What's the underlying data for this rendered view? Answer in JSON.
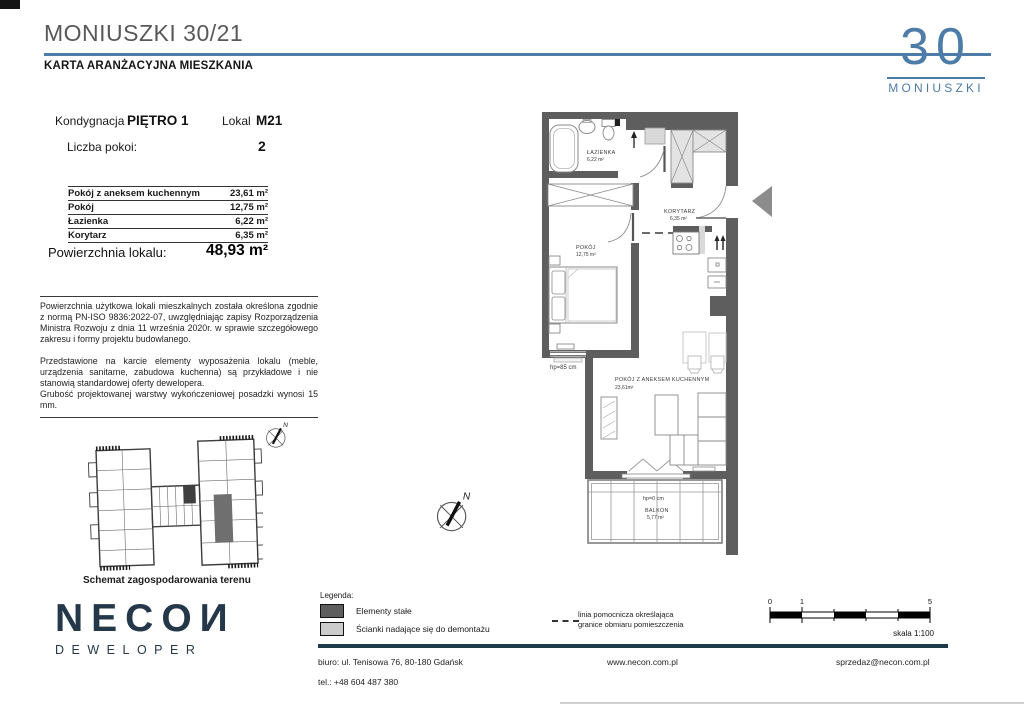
{
  "header": {
    "title": "MONIUSZKI 30/21",
    "subtitle": "KARTA ARANŻACYJNA MIESZKANIA",
    "logo_number": "30",
    "logo_name": "MONIUSZKI"
  },
  "info": {
    "kondygnacja_label": "Kondygnacja",
    "kondygnacja_value": "PIĘTRO 1",
    "lokal_label": "Lokal",
    "lokal_value": "M21",
    "liczba_pokoi_label": "Liczba pokoi:",
    "liczba_pokoi_value": "2",
    "rooms": [
      {
        "name": "Pokój z aneksem kuchennym",
        "area": "23,61 m²"
      },
      {
        "name": "Pokój",
        "area": "12,75 m²"
      },
      {
        "name": "Łazienka",
        "area": "6,22 m²"
      },
      {
        "name": "Korytarz",
        "area": "6,35 m²"
      }
    ],
    "total_label": "Powierzchnia lokalu:",
    "total_value": "48,93 m²"
  },
  "disclaimer": {
    "p1": "Powierzchnia użytkowa lokali mieszkalnych została określona zgodnie z normą PN-ISO 9836:2022-07, uwzględniając zapisy Rozporządzenia Ministra Rozwoju z dnia 11 września 2020r. w sprawie szczegółowego zakresu i formy projektu budowlanego.",
    "p2": "Przedstawione na karcie elementy wyposażenia lokalu (meble, urządzenia sanitarne, zabudowa kuchenna) są przykładowe i nie stanowią standardowej oferty dewelopera.",
    "p3": "Grubość projektowanej warstwy wykończeniowej posadzki wynosi 15 mm."
  },
  "site_plan": {
    "caption": "Schemat zagospodarowania terenu"
  },
  "developer": {
    "logo_text": "NECOИ",
    "logo_sub": "DEWELOPER"
  },
  "plan": {
    "rooms": {
      "lazienka": {
        "name": "ŁAZIENKA",
        "area": "6,22 m²"
      },
      "korytarz": {
        "name": "KORYTARZ",
        "area": "6,35 m²"
      },
      "pokoj": {
        "name": "POKÓJ",
        "area": "12,75 m²"
      },
      "salon": {
        "name": "POKÓJ Z ANEKSEM KUCHENNYM",
        "area": "23,61m²"
      },
      "balkon": {
        "name": "BALKON",
        "area": "5,77 m²"
      }
    },
    "hp_pokoj": "hp=85 cm",
    "hp_balkon": "hp=0 cm",
    "compass": "N"
  },
  "legend": {
    "title": "Legenda:",
    "items": [
      {
        "label": "Elementy stałe"
      },
      {
        "label": "Ścianki nadające się do demontażu"
      }
    ],
    "dashed_note_line1": "linia pomocnicza określająca",
    "dashed_note_line2": "granice obmiaru pomieszczenia"
  },
  "scale_bar": {
    "t0": "0",
    "t1": "1",
    "t5": "5",
    "label": "skala 1:100"
  },
  "footer": {
    "address": "biuro: ul. Tenisowa 76, 80-180 Gdańsk",
    "phone": "tel.: +48 604 487 380",
    "website": "www.necon.com.pl",
    "email": "sprzedaz@necon.com.pl"
  },
  "colors": {
    "accent_blue": "#4e7ca8",
    "navy": "#1e3948",
    "wall_fixed": "#5e5e5e",
    "wall_demountable": "#cccccc",
    "entry_arrow": "#8c8c8c"
  }
}
